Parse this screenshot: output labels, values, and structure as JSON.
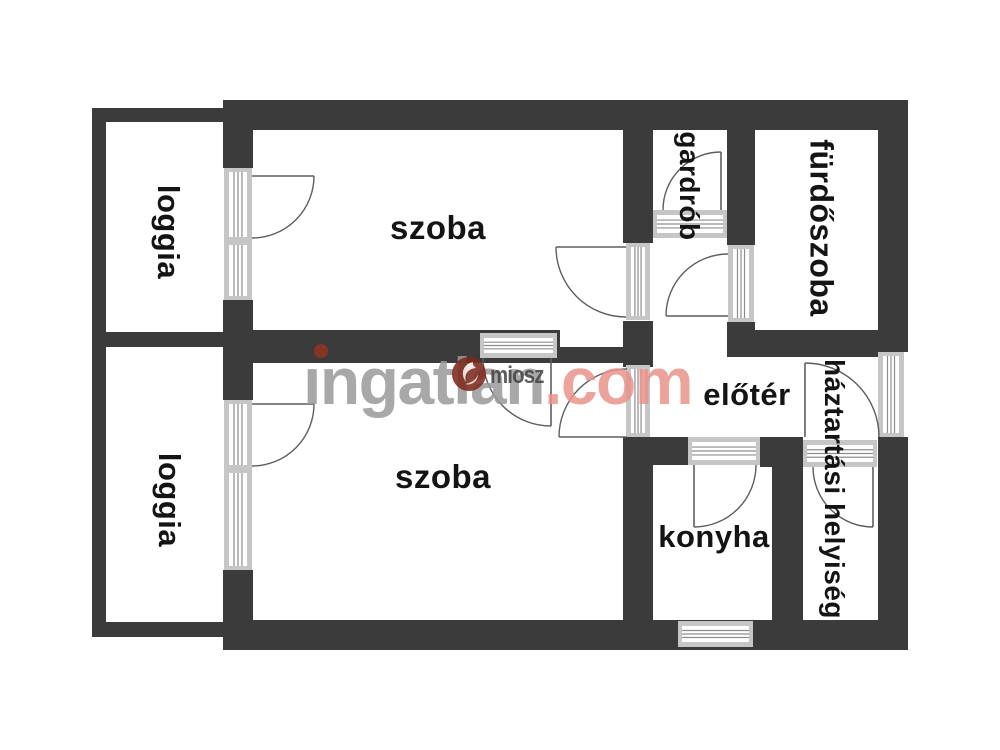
{
  "title": "apartment floor plan",
  "colors": {
    "wall": "#3b3b3b",
    "frame_rail": "#c6c6c6",
    "frame_line": "#8d8d8d",
    "door_stroke": "#5e5e5e",
    "label": "#141414",
    "watermark_gray": "#9a9a9a",
    "watermark_accent": "#e8938a",
    "watermark_dot": "#8e3424",
    "badge_bg": "#7e2b1d",
    "badge_text_color": "#454545"
  },
  "watermark": {
    "brand_gray": "ingatlan",
    "brand_accent": ".com",
    "badge_text": "miosz"
  },
  "rooms": [
    {
      "id": "szoba-top",
      "label": "szoba",
      "x": 438,
      "y": 228,
      "size": 33,
      "vertical": false
    },
    {
      "id": "szoba-bottom",
      "label": "szoba",
      "x": 443,
      "y": 477,
      "size": 33,
      "vertical": false
    },
    {
      "id": "elater",
      "label": "előtér",
      "x": 747,
      "y": 395,
      "size": 31,
      "vertical": false
    },
    {
      "id": "konyha",
      "label": "konyha",
      "x": 714,
      "y": 537,
      "size": 31,
      "vertical": false
    },
    {
      "id": "loggia-top",
      "label": "loggia",
      "x": 168,
      "y": 232,
      "size": 31,
      "vertical": true
    },
    {
      "id": "loggia-bottom",
      "label": "loggia",
      "x": 169,
      "y": 500,
      "size": 31,
      "vertical": true
    },
    {
      "id": "gardrob",
      "label": "gardrób",
      "x": 689,
      "y": 186,
      "size": 28,
      "vertical": true
    },
    {
      "id": "furdoszoba",
      "label": "fürdőszoba",
      "x": 821,
      "y": 228,
      "size": 32,
      "vertical": true
    },
    {
      "id": "haztartasi-helyiseg",
      "label": "háztartási helyiség",
      "x": 834,
      "y": 489,
      "size": 28,
      "vertical": true
    }
  ],
  "geometry": {
    "walls": [
      [
        223,
        100,
        685,
        30
      ],
      [
        878,
        100,
        30,
        252
      ],
      [
        878,
        437,
        30,
        213
      ],
      [
        225,
        620,
        683,
        30
      ],
      [
        92,
        108,
        14,
        529
      ],
      [
        92,
        108,
        133,
        14
      ],
      [
        92,
        332,
        133,
        15
      ],
      [
        92,
        622,
        133,
        15
      ],
      [
        223,
        100,
        30,
        68
      ],
      [
        223,
        300,
        30,
        100
      ],
      [
        223,
        570,
        30,
        80
      ],
      [
        225,
        330,
        335,
        33
      ],
      [
        560,
        347,
        93,
        16
      ],
      [
        623,
        321,
        30,
        46
      ],
      [
        623,
        100,
        30,
        143
      ],
      [
        623,
        437,
        30,
        183
      ],
      [
        727,
        100,
        28,
        145
      ],
      [
        727,
        322,
        28,
        35
      ],
      [
        727,
        330,
        151,
        27
      ],
      [
        653,
        437,
        35,
        28
      ],
      [
        760,
        437,
        43,
        30
      ],
      [
        772,
        437,
        31,
        183
      ]
    ],
    "frames": [
      {
        "x": 224,
        "y": 168,
        "w": 28,
        "h": 132,
        "orient": "v",
        "sills": [
          237
        ]
      },
      {
        "x": 224,
        "y": 400,
        "w": 28,
        "h": 170,
        "orient": "v",
        "sills": [
          465
        ]
      },
      {
        "x": 626,
        "y": 243,
        "w": 24,
        "h": 77,
        "orient": "v",
        "sills": []
      },
      {
        "x": 626,
        "y": 365,
        "w": 24,
        "h": 72,
        "orient": "v",
        "sills": []
      },
      {
        "x": 728,
        "y": 245,
        "w": 26,
        "h": 77,
        "orient": "v",
        "sills": []
      },
      {
        "x": 878,
        "y": 352,
        "w": 26,
        "h": 85,
        "orient": "v",
        "sills": []
      },
      {
        "x": 480,
        "y": 333,
        "w": 77,
        "h": 25,
        "orient": "h",
        "sills": []
      },
      {
        "x": 653,
        "y": 210,
        "w": 74,
        "h": 28,
        "orient": "h",
        "sills": []
      },
      {
        "x": 688,
        "y": 437,
        "w": 72,
        "h": 28,
        "orient": "h",
        "sills": []
      },
      {
        "x": 803,
        "y": 440,
        "w": 74,
        "h": 27,
        "orient": "h",
        "sills": []
      },
      {
        "x": 678,
        "y": 621,
        "w": 75,
        "h": 26,
        "orient": "h",
        "sills": []
      }
    ],
    "doors": [
      {
        "leaf": [
          252,
          176,
          314,
          176
        ],
        "arc": "M314,176 A62,62 0 0 1 252,238"
      },
      {
        "leaf": [
          252,
          404,
          314,
          404
        ],
        "arc": "M314,404 A62,62 0 0 1 252,466"
      },
      {
        "leaf": [
          626,
          247,
          556,
          247
        ],
        "arc": "M556,247 A70,70 0 0 0 626,317"
      },
      {
        "leaf": [
          627,
          437,
          559,
          437
        ],
        "arc": "M627,369 A68,68 0 0 0 559,437"
      },
      {
        "leaf": [
          721,
          210,
          721,
          152
        ],
        "arc": "M721,152 A58,58 0 0 0 663,210"
      },
      {
        "leaf": [
          728,
          316,
          666,
          316
        ],
        "arc": "M728,254 A62,62 0 0 0 666,316"
      },
      {
        "leaf": [
          694,
          465,
          694,
          527
        ],
        "arc": "M694,527 A62,62 0 0 0 756,465"
      },
      {
        "leaf": [
          551,
          358,
          551,
          426
        ],
        "arc": "M483,358 A68,68 0 0 0 551,426"
      },
      {
        "leaf": [
          805,
          437,
          805,
          363
        ],
        "arc": "M805,363 A74,74 0 0 1 879,437"
      },
      {
        "leaf": [
          873,
          467,
          873,
          527
        ],
        "arc": "M813,467 A60,60 0 0 0 873,527"
      }
    ]
  }
}
